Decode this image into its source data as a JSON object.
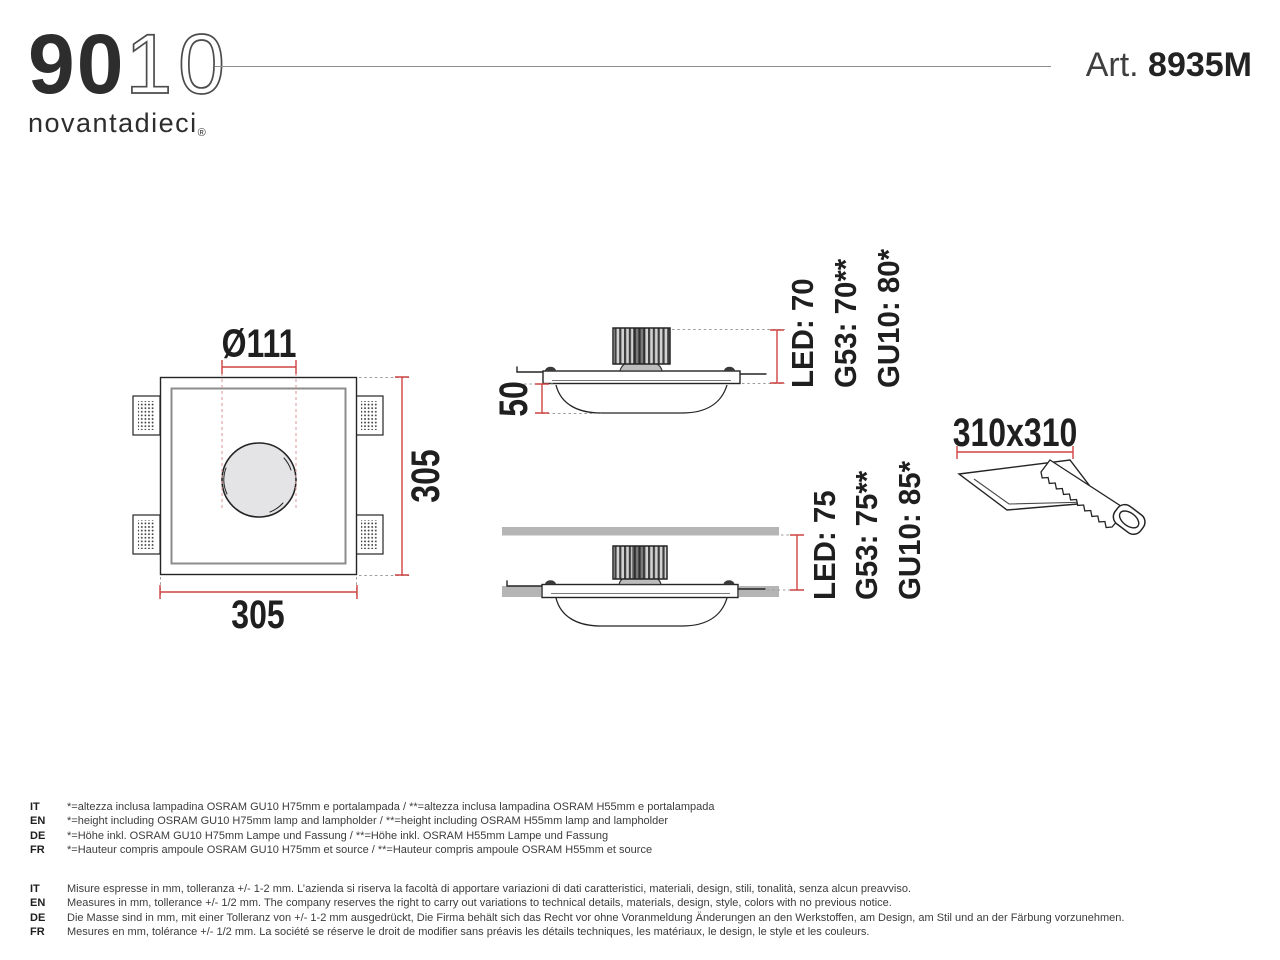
{
  "header": {
    "logo_bold": "90",
    "logo_light": "10",
    "logo_name": "novantadieci",
    "logo_reg": "®",
    "art_prefix": "Art. ",
    "art_number": "8935M"
  },
  "drawing": {
    "front_view": {
      "diameter": "Ø111",
      "height": "305",
      "width": "305"
    },
    "section_surface": {
      "depth": "50",
      "lamp_heights": [
        "LED: 70",
        "G53: 70**",
        "GU10: 80*"
      ]
    },
    "section_recessed": {
      "lamp_heights": [
        "LED: 75",
        "G53: 75**",
        "GU10: 85*"
      ]
    },
    "cutout_size": "310x310"
  },
  "colors": {
    "dim-red": "#cf4444",
    "leader-pink": "#e4a6a6",
    "slab-gray": "#b5b5b5",
    "hole-gray": "#e4e4e6"
  },
  "notes_lamp": [
    {
      "lang": "IT",
      "text": "*=altezza inclusa lampadina OSRAM GU10 H75mm e portalampada / **=altezza inclusa lampadina OSRAM H55mm e portalampada"
    },
    {
      "lang": "EN",
      "text": "*=height including OSRAM GU10 H75mm lamp and lampholder / **=height including OSRAM H55mm lamp and lampholder"
    },
    {
      "lang": "DE",
      "text": "*=Höhe inkl. OSRAM GU10 H75mm Lampe und Fassung / **=Höhe inkl. OSRAM H55mm Lampe und Fassung"
    },
    {
      "lang": "FR",
      "text": "*=Hauteur compris ampoule OSRAM GU10 H75mm et source / **=Hauteur compris ampoule OSRAM H55mm et source"
    }
  ],
  "notes_general": [
    {
      "lang": "IT",
      "text": "Misure espresse in mm, tolleranza +/- 1-2 mm. L’azienda si riserva la facoltà di apportare variazioni di dati caratteristici, materiali, design, stili, tonalità, senza alcun preavviso."
    },
    {
      "lang": "EN",
      "text": "Measures in mm, tollerance +/- 1/2 mm. The company reserves the right to carry out variations to technical details, materials, design, style, colors with no previous notice."
    },
    {
      "lang": "DE",
      "text": "Die Masse sind in mm, mit einer Tolleranz von +/- 1-2 mm ausgedrückt, Die Firma behält sich das Recht vor ohne Voranmeldung Änderungen an den Werkstoffen, am Design, am Stil und an der Färbung vorzunehmen."
    },
    {
      "lang": "FR",
      "text": "Mesures en mm, tolérance +/- 1/2 mm. La société se réserve le droit de modifier sans préavis les détails techniques, les matériaux, le design, le style et les couleurs."
    }
  ]
}
